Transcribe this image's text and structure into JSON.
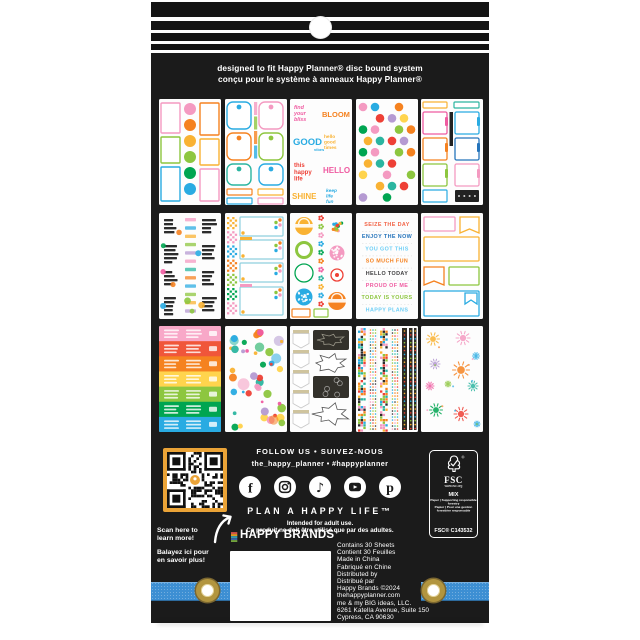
{
  "header": {
    "line1": "designed to fit Happy Planner® disc bound system",
    "line2": "conçu pour le système à anneaux Happy Planner®"
  },
  "palette": {
    "pink": "#ef5ba1",
    "lightpink": "#f49ac1",
    "red": "#ee4036",
    "orange": "#f58220",
    "amber": "#f9b233",
    "yellow": "#ffd44d",
    "green": "#8dc63f",
    "dkgreen": "#00a551",
    "teal": "#2bb5a0",
    "blue": "#29abe2",
    "dkblue": "#2574bb",
    "lav": "#b59ad2",
    "ink": "#2d2d2d"
  },
  "colors": {
    "package": "#1b1b1b",
    "stripe": "#141414",
    "band_blue": "#3d8fd3",
    "grommet_gold": "#b2953f",
    "qr_border": "#eaa337"
  },
  "sheets": [
    {
      "name": "boxes-labels-sheet",
      "type": "labels"
    },
    {
      "name": "pocket-tabs-sheet",
      "type": "pockets"
    },
    {
      "name": "word-stickers-sheet",
      "type": "phrases",
      "phrases": [
        "find your bliss",
        "BLOOM",
        "GOOD vibes",
        "hello good times",
        "this happy life",
        "HELLO",
        "SHINE",
        "keep life fun"
      ]
    },
    {
      "name": "polka-dots-sheet",
      "type": "dotgrid"
    },
    {
      "name": "note-tabs-sheet",
      "type": "sidetabs"
    },
    {
      "name": "word-art-sheet",
      "type": "wordart"
    },
    {
      "name": "checker-boxes-sheet",
      "type": "checkerboxes"
    },
    {
      "name": "circles-sheet",
      "type": "circlemix"
    },
    {
      "name": "phrase-list-sheet",
      "type": "phraselist",
      "phrases": [
        "SEIZE THE DAY",
        "ENJOY THE NOW",
        "YOU GOT THIS",
        "SO MUCH FUN",
        "HELLO TODAY",
        "PROUD OF ME",
        "TODAY IS YOURS",
        "HAPPY PLANS"
      ],
      "colors": [
        "#f26649",
        "#2574bb",
        "#6dcff6",
        "#f58220",
        "#414042",
        "#ef5ba1",
        "#8dc63f",
        "#6dcff6"
      ]
    },
    {
      "name": "boxes-banners-sheet",
      "type": "boxbanners"
    },
    {
      "name": "rainbow-rows-sheet",
      "type": "rainbowrows"
    },
    {
      "name": "confetti-dots-sheet",
      "type": "scatter"
    },
    {
      "name": "arrows-splats-sheet",
      "type": "arrowsplats"
    },
    {
      "name": "washi-strips-sheet",
      "type": "washi"
    },
    {
      "name": "starburst-sheet",
      "type": "starburst"
    }
  ],
  "follow": {
    "line1": "FOLLOW US • SUIVEZ-NOUS",
    "handle": "the_happy_planner • #happyplanner",
    "tagline": "PLAN A HAPPY LIFE™",
    "adult_en": "Intended for adult use.",
    "adult_fr": "Ce produit ne doit être utilisé que par des adultes."
  },
  "socials": [
    "facebook",
    "instagram",
    "tiktok",
    "youtube",
    "pinterest"
  ],
  "fsc": {
    "name": "FSC",
    "url": "www.fsc.org",
    "grade": "MIX",
    "line_en": "Paper | Supporting responsible forestry",
    "line_fr": "Papier | Pour une gestion forestière responsable",
    "cert": "FSC® C143532"
  },
  "scan": {
    "lines": [
      "Scan here to",
      "learn more!",
      "Balayez ici pour",
      "en savoir plus!"
    ]
  },
  "brand": {
    "name": "HAPPY BRANDS",
    "tm": "™"
  },
  "info_lines": [
    "Contains 30 Sheets",
    "Contient 30 Feuilles",
    "Made in China",
    "Fabriqué en Chine",
    "Distributed by",
    "Distribué par",
    "Happy Brands ©2024",
    "thehappyplanner.com",
    "me & my BIG ideas, LLC.",
    "6261 Katella Avenue, Suite 150",
    "Cypress, CA 90630"
  ]
}
